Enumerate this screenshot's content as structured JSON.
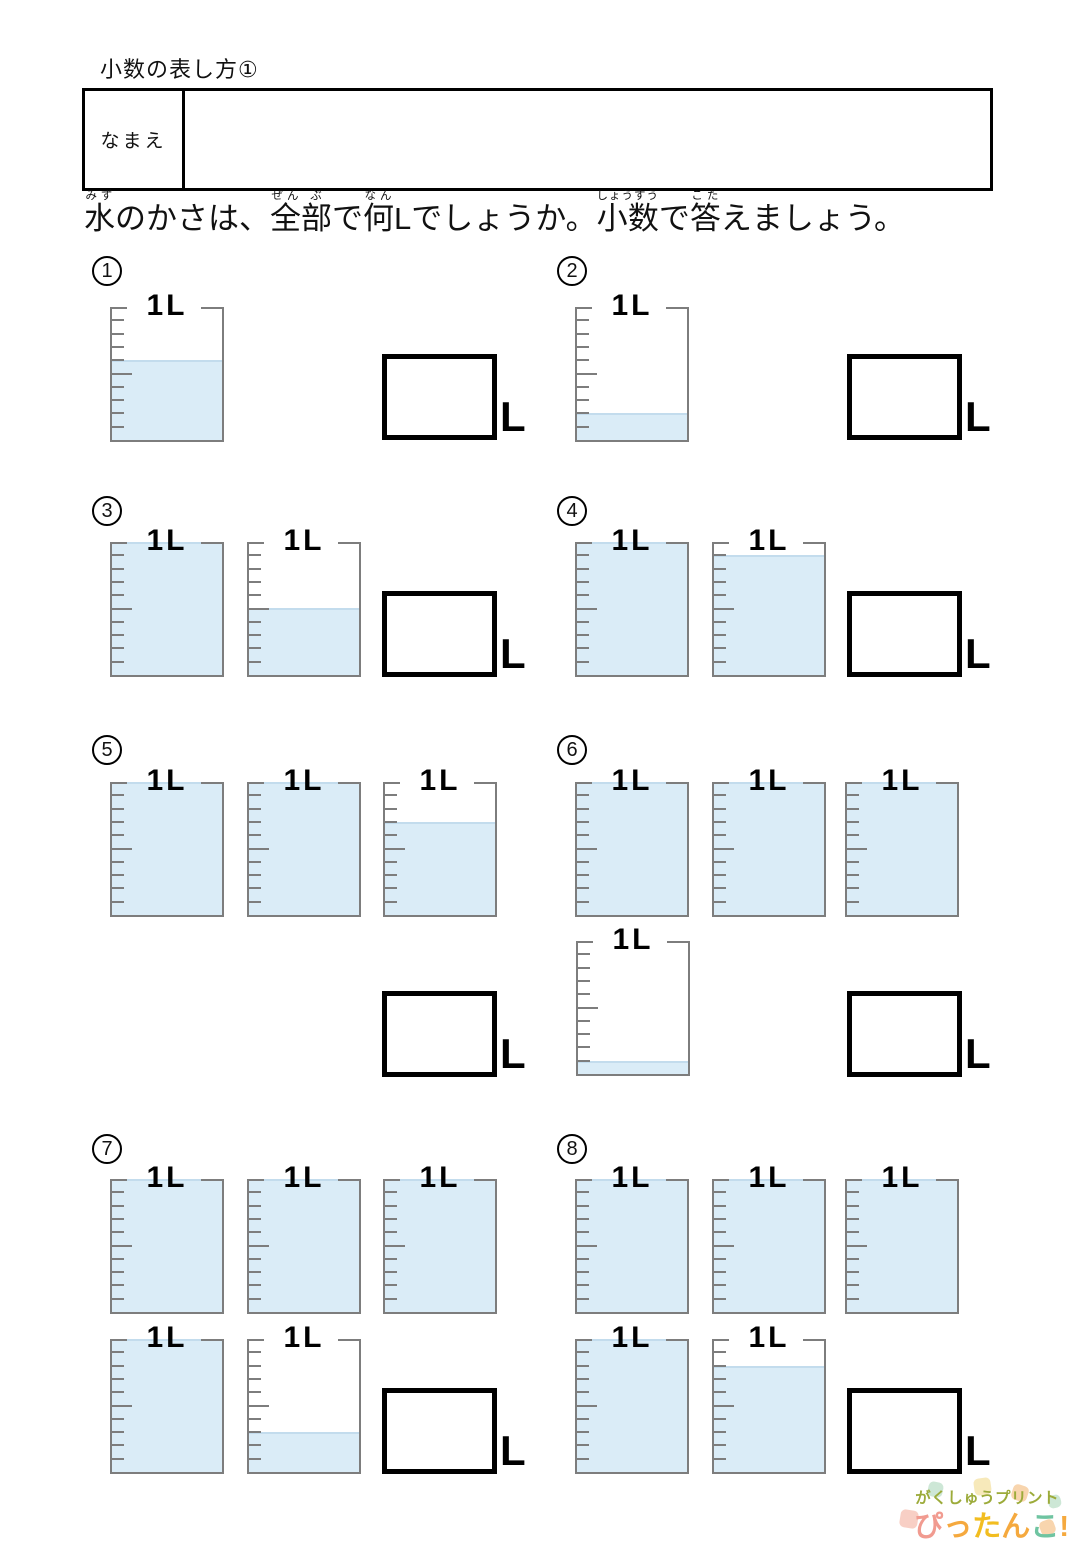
{
  "page": {
    "title": "小数の表し方①",
    "name_box": {
      "label": "なまえ",
      "value": ""
    },
    "instruction": {
      "text": "水のかさは、全部で何Lでしょうか。小数で答えましょう。",
      "segments": [
        {
          "base": "水",
          "ruby": "みず"
        },
        {
          "base": "のかさは、",
          "ruby": ""
        },
        {
          "base": "全",
          "ruby": "ぜん"
        },
        {
          "base": "部",
          "ruby": "ぶ"
        },
        {
          "base": "で",
          "ruby": ""
        },
        {
          "base": "何",
          "ruby": "なん"
        },
        {
          "base": "Lでしょうか。",
          "ruby": ""
        },
        {
          "base": "小数",
          "ruby": "しょうすう"
        },
        {
          "base": "で",
          "ruby": ""
        },
        {
          "base": "答",
          "ruby": "こた"
        },
        {
          "base": "えましょう。",
          "ruby": ""
        }
      ]
    }
  },
  "beaker": {
    "capacity_label": "1L",
    "ticks_per_liter": 10
  },
  "answer": {
    "unit_label": "L"
  },
  "problems": [
    {
      "number": "1",
      "beaker_fills_l": [
        0.6
      ],
      "answer_value": ""
    },
    {
      "number": "2",
      "beaker_fills_l": [
        0.2
      ],
      "answer_value": ""
    },
    {
      "number": "3",
      "beaker_fills_l": [
        1.0,
        0.5
      ],
      "answer_value": ""
    },
    {
      "number": "4",
      "beaker_fills_l": [
        1.0,
        0.9
      ],
      "answer_value": ""
    },
    {
      "number": "5",
      "beaker_fills_l": [
        1.0,
        1.0,
        0.7
      ],
      "answer_value": ""
    },
    {
      "number": "6",
      "beaker_fills_l": [
        1.0,
        1.0,
        1.0,
        0.1
      ],
      "answer_value": ""
    },
    {
      "number": "7",
      "beaker_fills_l": [
        1.0,
        1.0,
        1.0,
        1.0,
        0.3
      ],
      "answer_value": ""
    },
    {
      "number": "8",
      "beaker_fills_l": [
        1.0,
        1.0,
        1.0,
        1.0,
        0.8
      ],
      "answer_value": ""
    }
  ],
  "colors": {
    "water_fill": "#daecf7",
    "water_edge": "#c3dced",
    "beaker_outline": "#7d7d7d",
    "answer_box_border": "#000000"
  },
  "logo": {
    "line1": "がくしゅうプリント",
    "line1_color": "#9cab3a",
    "line2_chars": [
      {
        "ch": "ぴ",
        "color": "#f19b90"
      },
      {
        "ch": "っ",
        "color": "#f5a93e"
      },
      {
        "ch": "た",
        "color": "#f2bd20"
      },
      {
        "ch": "ん",
        "color": "#f5a93e"
      },
      {
        "ch": "こ",
        "color": "#6fc4a1"
      },
      {
        "ch": "!",
        "color": "#f5a93e"
      }
    ]
  }
}
